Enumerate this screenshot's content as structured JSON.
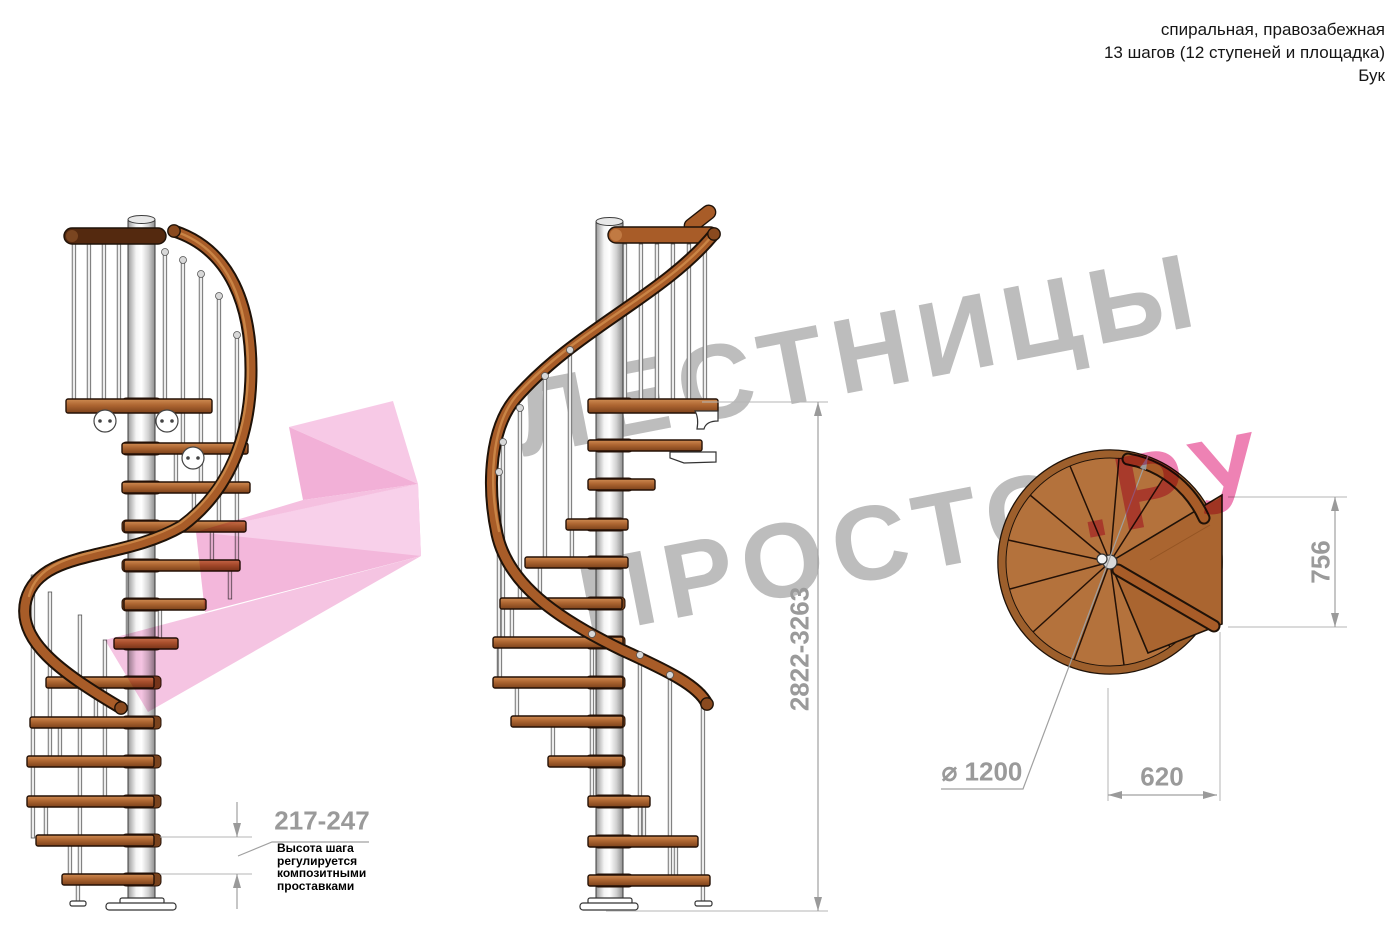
{
  "header": {
    "line1": "спиральная, правозабежная",
    "line2": "13 шагов (12 ступеней и площадка)",
    "line3": "Бук"
  },
  "watermark": {
    "line1": "ЛЕСТНИЦЫ",
    "line2_gray": "ПРОСТО",
    "line2_pink": ".РУ"
  },
  "dimensions": {
    "total_height": "2822-3263",
    "step_height": "217-247",
    "plan_depth": "756",
    "plan_width": "620",
    "diameter": "⌀ 1200",
    "note": [
      "Высота шага",
      "регулируется",
      "композитными",
      "проставками"
    ]
  },
  "colors": {
    "dimension_gray": "#9a9a9a",
    "watermark_gray": "#bdbdbd",
    "watermark_pink": "#ee82b4",
    "arrow_pink": "#f3b7db",
    "wood": "#ab6130",
    "wood_dark": "#7a431d",
    "metal": "#ececec"
  }
}
